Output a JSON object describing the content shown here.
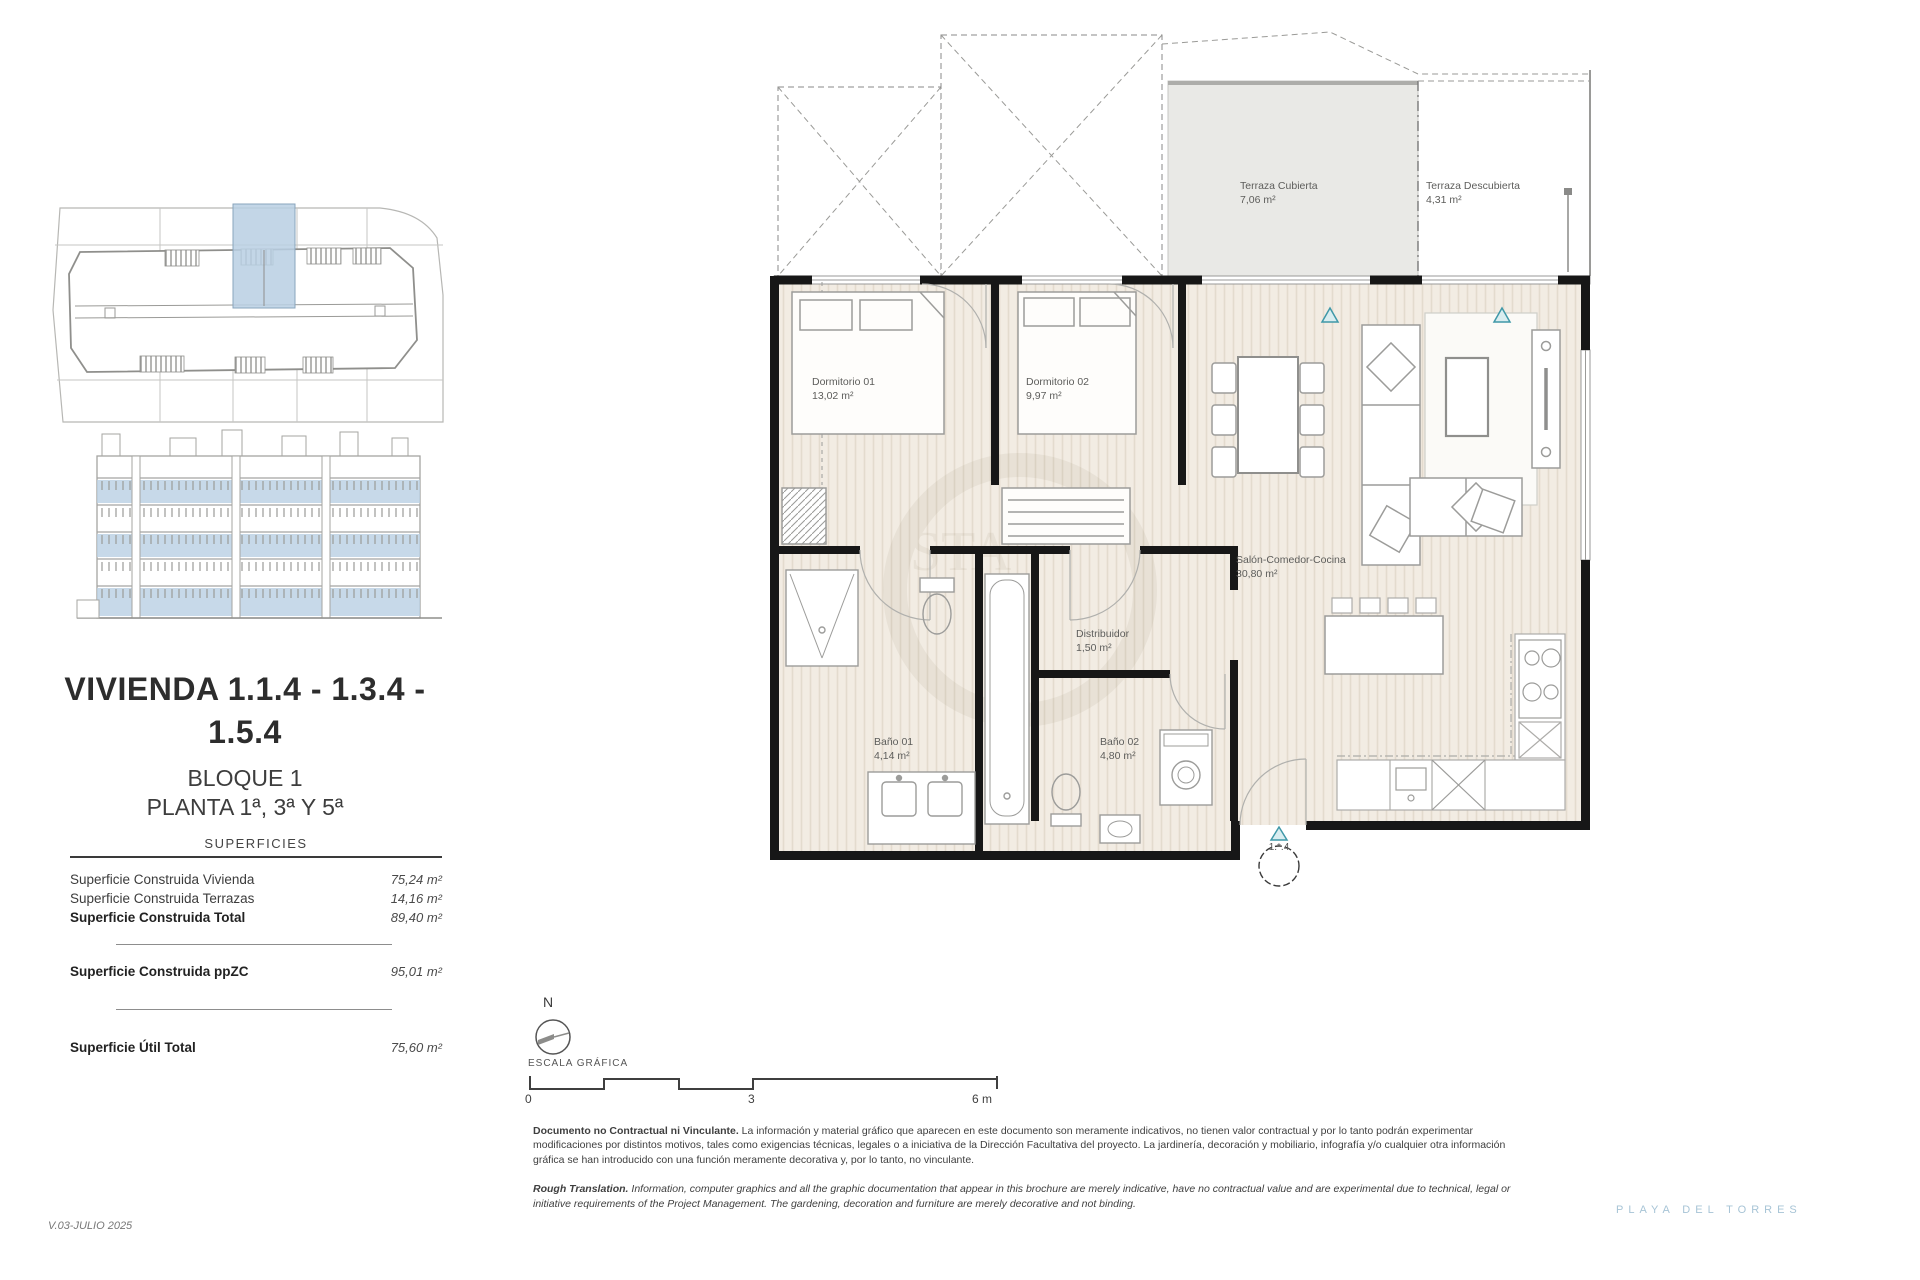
{
  "meta": {
    "version": "V.03-JULIO 2025",
    "brand": "PLAYA DEL TORRES"
  },
  "sidebar": {
    "title_line1": "VIVIENDA 1.1.4 - 1.3.4 -",
    "title_line2": "1.5.4",
    "block": "BLOQUE 1",
    "floor": "PLANTA 1ª, 3ª Y 5ª",
    "surfaces_header": "SUPERFICIES",
    "surfaces": [
      {
        "label": "Superficie Construida Vivienda",
        "value": "75,24 m²"
      },
      {
        "label": "Superficie Construida Terrazas",
        "value": "14,16 m²"
      },
      {
        "label": "Superficie Construida Total",
        "value": "89,40 m²"
      },
      {
        "label": "Superficie Construida ppZC",
        "value": "95,01 m²"
      },
      {
        "label": "Superficie Útil Total",
        "value": "75,60 m²"
      }
    ]
  },
  "plan": {
    "rooms": [
      {
        "name": "Terraza Cubierta",
        "area": "7,06 m²"
      },
      {
        "name": "Terraza Descubierta",
        "area": "4,31 m²"
      },
      {
        "name": "Dormitorio 01",
        "area": "13,02 m²"
      },
      {
        "name": "Dormitorio 02",
        "area": "9,97 m²"
      },
      {
        "name": "Salón-Comedor-Cocina",
        "area": "30,80 m²"
      },
      {
        "name": "Distribuidor",
        "area": "1,50 m²"
      },
      {
        "name": "Baño 01",
        "area": "4,14 m²"
      },
      {
        "name": "Baño 02",
        "area": "4,80 m²"
      }
    ],
    "entrance_label": "1.*.4"
  },
  "compass": {
    "north_label": "N"
  },
  "scale_bar": {
    "label": "ESCALA GRÁFICA",
    "ticks": [
      "0",
      "3",
      "6 m"
    ]
  },
  "disclaimer": {
    "es_lead": "Documento no Contractual ni Vinculante.",
    "es_body": " La información y material gráfico que aparecen en este documento son meramente indicativos, no tienen valor contractual y por lo tanto podrán experimentar modificaciones por distintos motivos, tales como exigencias técnicas, legales o a iniciativa de la Dirección Facultativa del proyecto. La jardinería, decoración y mobiliario, infografía y/o cualquier otra información gráfica se han introducido con una función meramente decorativa y, por lo tanto, no vinculante.",
    "en_lead": "Rough Translation.",
    "en_body": " Information, computer graphics and all the graphic documentation that appear in this brochure are merely indicative, have no contractual value and are experimental due to technical, legal or initiative requirements of the Project Management. The gardening, decoration and furniture are merely decorative and not binding."
  },
  "colors": {
    "highlight": "#b9cfe3",
    "accent_teal": "#4aa3b0",
    "brand_blue": "#a7c4d6",
    "wall": "#171717",
    "floor": "#f2ece3"
  }
}
